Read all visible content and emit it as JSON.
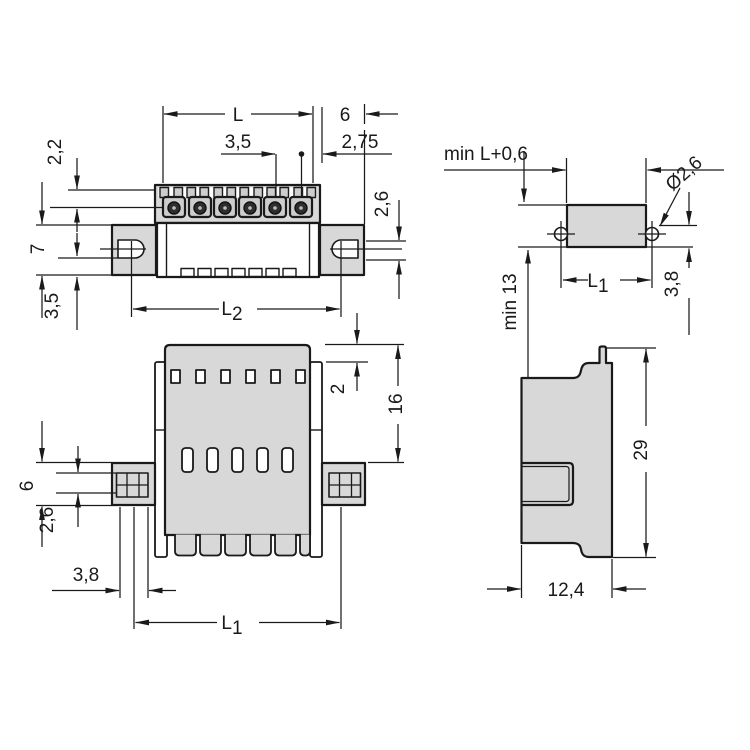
{
  "title": "connector-dimension-drawing",
  "colors": {
    "line": "#1a1a1a",
    "body_fill": "#d8d8d8",
    "detail_fill": "#cdcdcd",
    "screw": "#2e2e2e",
    "screw_dot": "#bdbdbd",
    "background": "#ffffff"
  },
  "views": {
    "front": {
      "dims": {
        "L": "L",
        "pitch": "3,5",
        "side_gap": "6",
        "edge_offset": "2,75",
        "comb_height": "2,2",
        "flange_height": "7",
        "foot_offset": "3,5",
        "pin_drop": "2,6",
        "L2_main": "L",
        "L2_sub": "2"
      }
    },
    "top": {
      "dims": {
        "min_length": "min L+0,6",
        "hole_dia": "Ø2,6",
        "min_depth": "min 13",
        "L1_main": "L",
        "L1_sub": "1",
        "hole_offset": "3,8"
      }
    },
    "back": {
      "dims": {
        "rail_offset": "2",
        "body_height": "16",
        "flange_height": "6",
        "clamp_height": "2,6",
        "pin_offset": "3,8",
        "L1_main": "L",
        "L1_sub": "1"
      }
    },
    "side": {
      "dims": {
        "total_height": "29",
        "depth": "12,4"
      }
    }
  }
}
